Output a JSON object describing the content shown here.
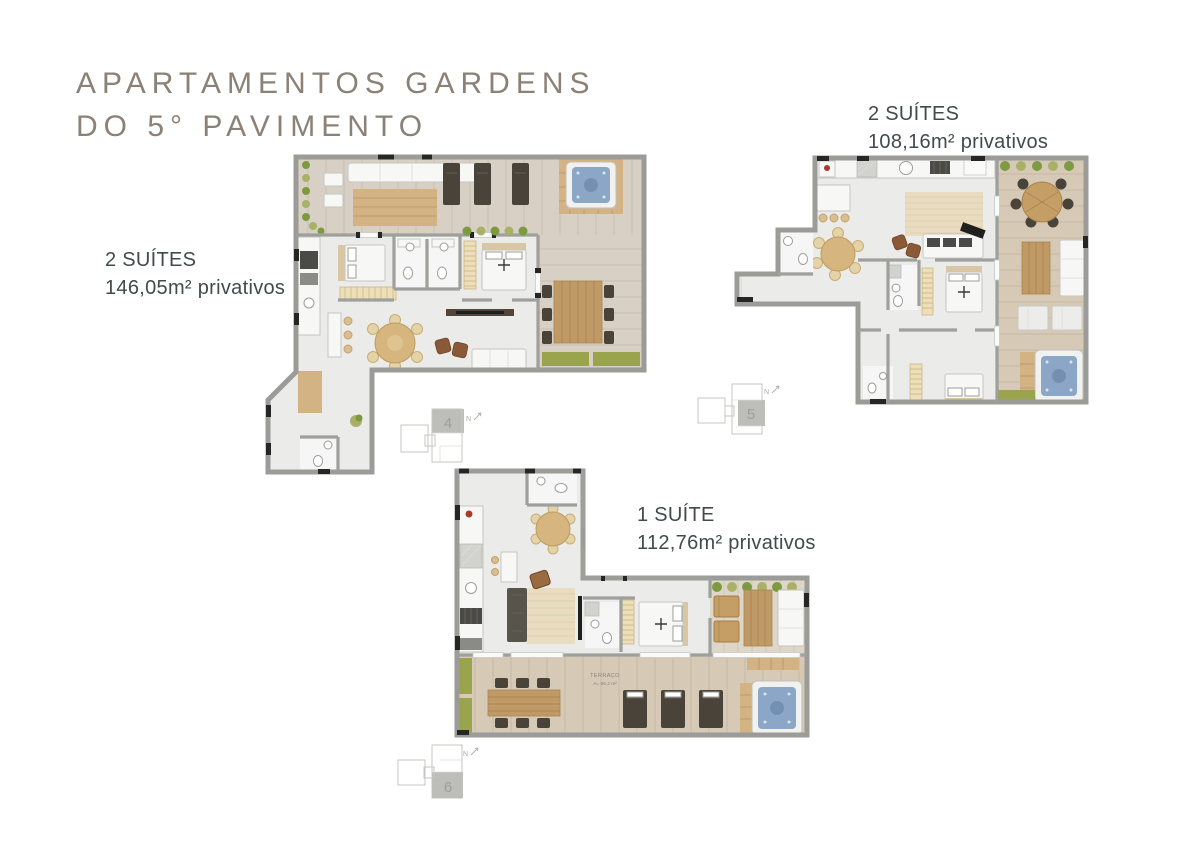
{
  "title": {
    "line1": "APARTAMENTOS GARDENS",
    "line2": "DO 5° PAVIMENTO"
  },
  "units": [
    {
      "suites": "2 SUÍTES",
      "area": "146,05m² privativos",
      "keyplan": "4",
      "north": "N"
    },
    {
      "suites": "2 SUÍTES",
      "area": "108,16m² privativos",
      "keyplan": "5",
      "north": "N"
    },
    {
      "suites": "1 SUÍTE",
      "area": "112,76m² privativos",
      "keyplan": "6",
      "north": "N",
      "terrace_label": "TERRAÇO",
      "terrace_area": "A= 56,2 m²"
    }
  ],
  "colors": {
    "background": "#ffffff",
    "title_text": "#8b8176",
    "label_text": "#414b4e",
    "wall_gray": "#9b9b97",
    "deck_tan": "#d6cab7",
    "interior_floor": "#ebecea",
    "planter_green": "#9aa44c",
    "wood_furniture": "#c09a66",
    "dark_furniture": "#49433a",
    "hot_tub_water": "#8ba6c6",
    "keyplan_gray": "#c6c6c2"
  }
}
